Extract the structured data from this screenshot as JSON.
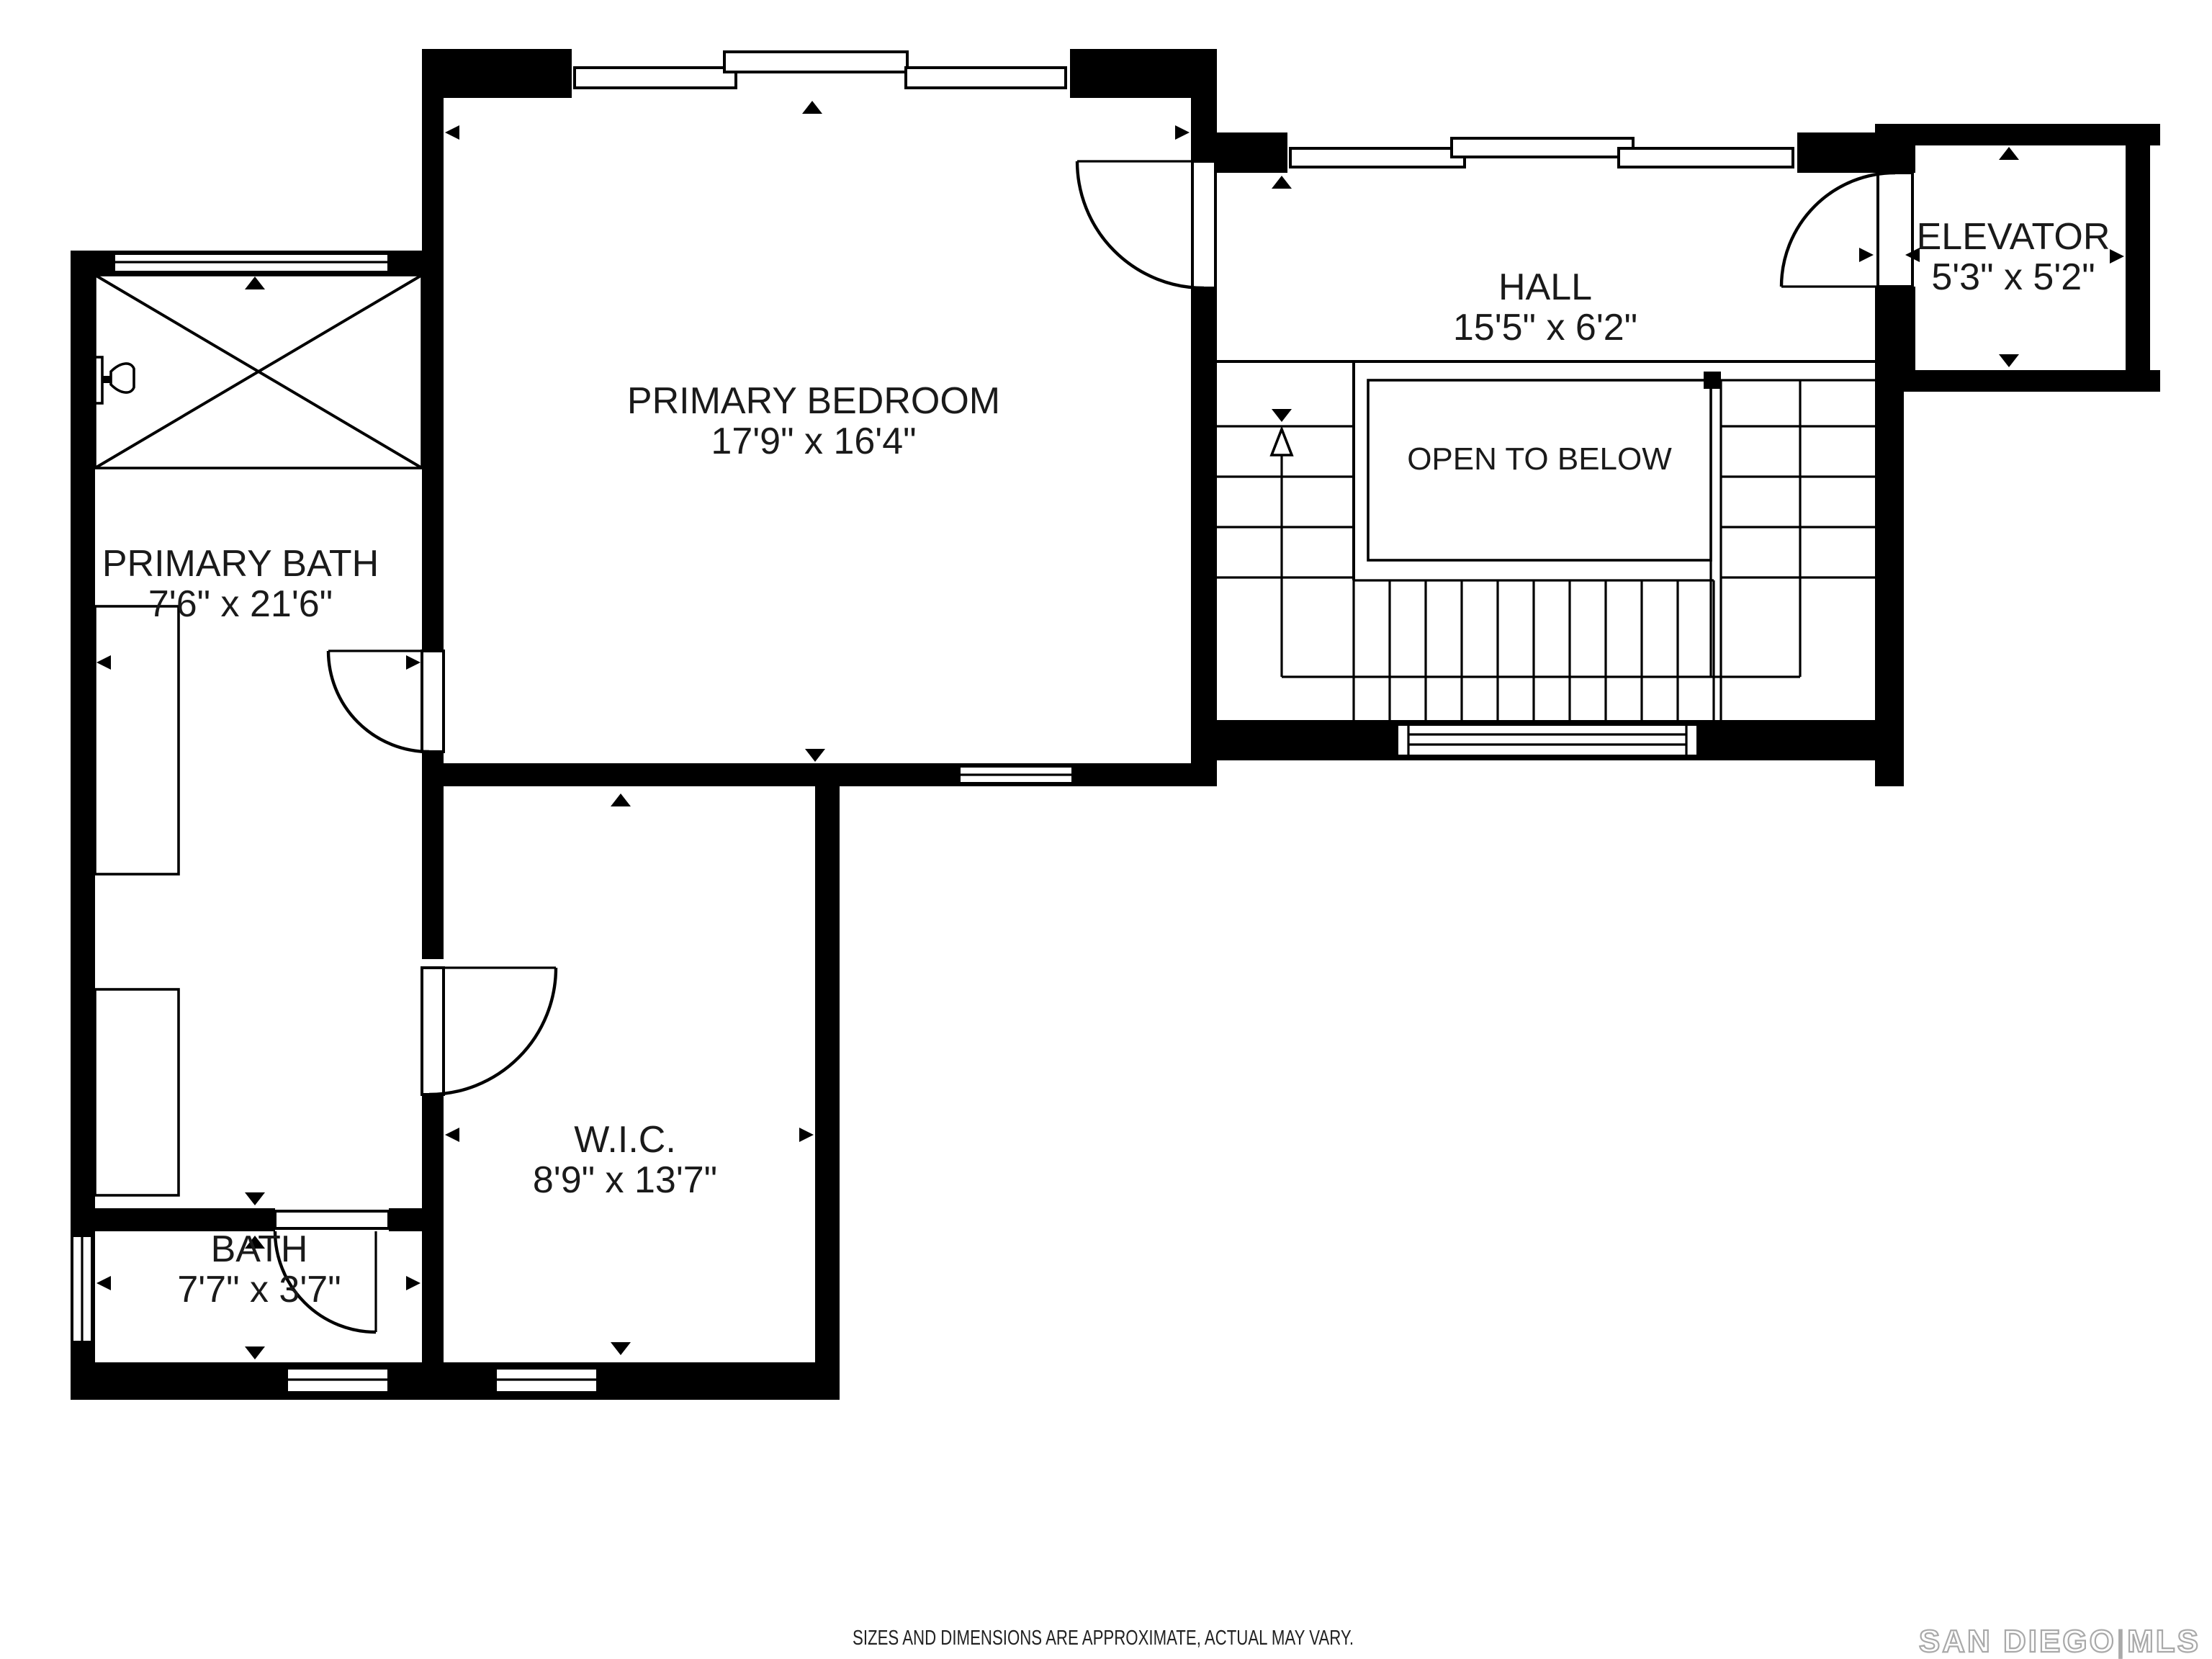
{
  "plan": {
    "rooms": {
      "primary_bedroom": {
        "name": "PRIMARY BEDROOM",
        "dims": "17'9\" x 16'4\""
      },
      "primary_bath": {
        "name": "PRIMARY BATH",
        "dims": "7'6\" x 21'6\""
      },
      "hall": {
        "name": "HALL",
        "dims": "15'5\" x 6'2\""
      },
      "elevator": {
        "name": "ELEVATOR",
        "dims": "5'3\" x 5'2\""
      },
      "wic": {
        "name": "W.I.C.",
        "dims": "8'9\" x 13'7\""
      },
      "bath": {
        "name": "BATH",
        "dims": "7'7\" x 3'7\""
      }
    },
    "stairs": {
      "open_label": "OPEN TO BELOW"
    },
    "footer": {
      "disclaimer": "SIZES AND DIMENSIONS ARE APPROXIMATE, ACTUAL MAY VARY."
    },
    "watermark": {
      "brand": "SAN DIEGO",
      "divider": "|",
      "suffix": "MLS"
    },
    "colors": {
      "walls": "#000000",
      "background": "#ffffff",
      "watermark": "#a9a9a9",
      "text": "#1a1a1a"
    }
  }
}
